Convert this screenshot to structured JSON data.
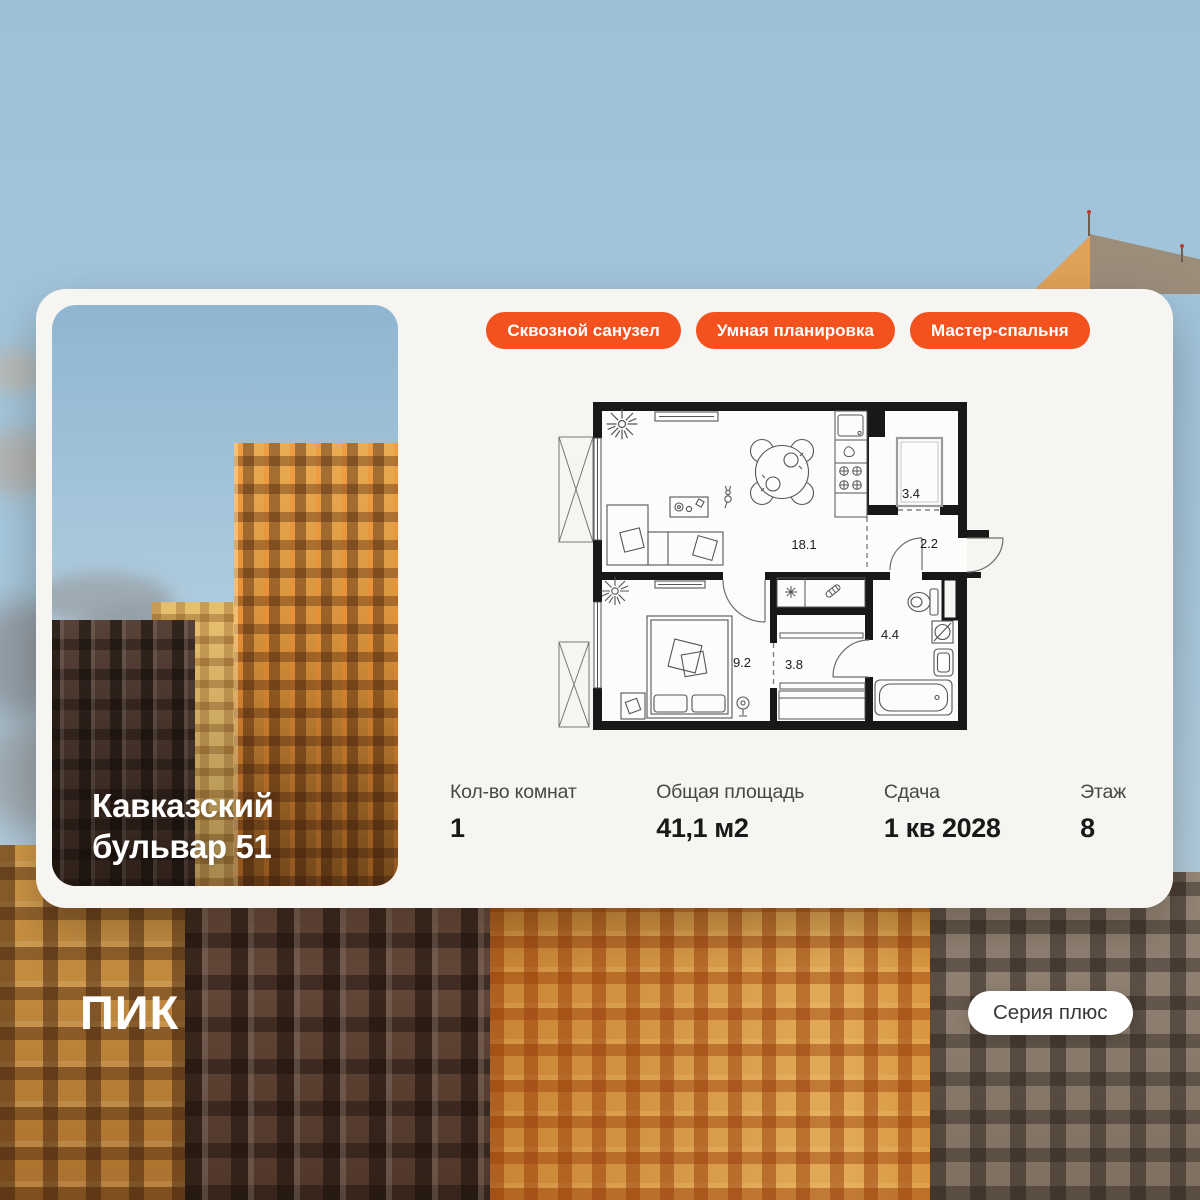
{
  "card": {
    "title": "Кавказский бульвар 51",
    "tags": [
      "Сквозной санузел",
      "Умная планировка",
      "Мастер-спальня"
    ],
    "floorplan": {
      "rooms": [
        {
          "id": "living-kitchen",
          "area": "18.1"
        },
        {
          "id": "shower-room",
          "area": "3.4"
        },
        {
          "id": "hallway",
          "area": "2.2"
        },
        {
          "id": "bathroom",
          "area": "4.4"
        },
        {
          "id": "bedroom",
          "area": "9.2"
        },
        {
          "id": "corridor",
          "area": "3.8"
        }
      ]
    },
    "stats": [
      {
        "label": "Кол-во комнат",
        "value": "1"
      },
      {
        "label": "Общая площадь",
        "value": "41,1 м2"
      },
      {
        "label": "Сдача",
        "value": "1 кв 2028"
      },
      {
        "label": "Этаж",
        "value": "8"
      }
    ]
  },
  "footer": {
    "logo": "ПИК",
    "series_badge": "Серия плюс"
  },
  "colors": {
    "accent": "#F3511E",
    "card_bg": "#F7F5F1",
    "sky": "#A3C6DC",
    "plan_wall": "#181818"
  }
}
